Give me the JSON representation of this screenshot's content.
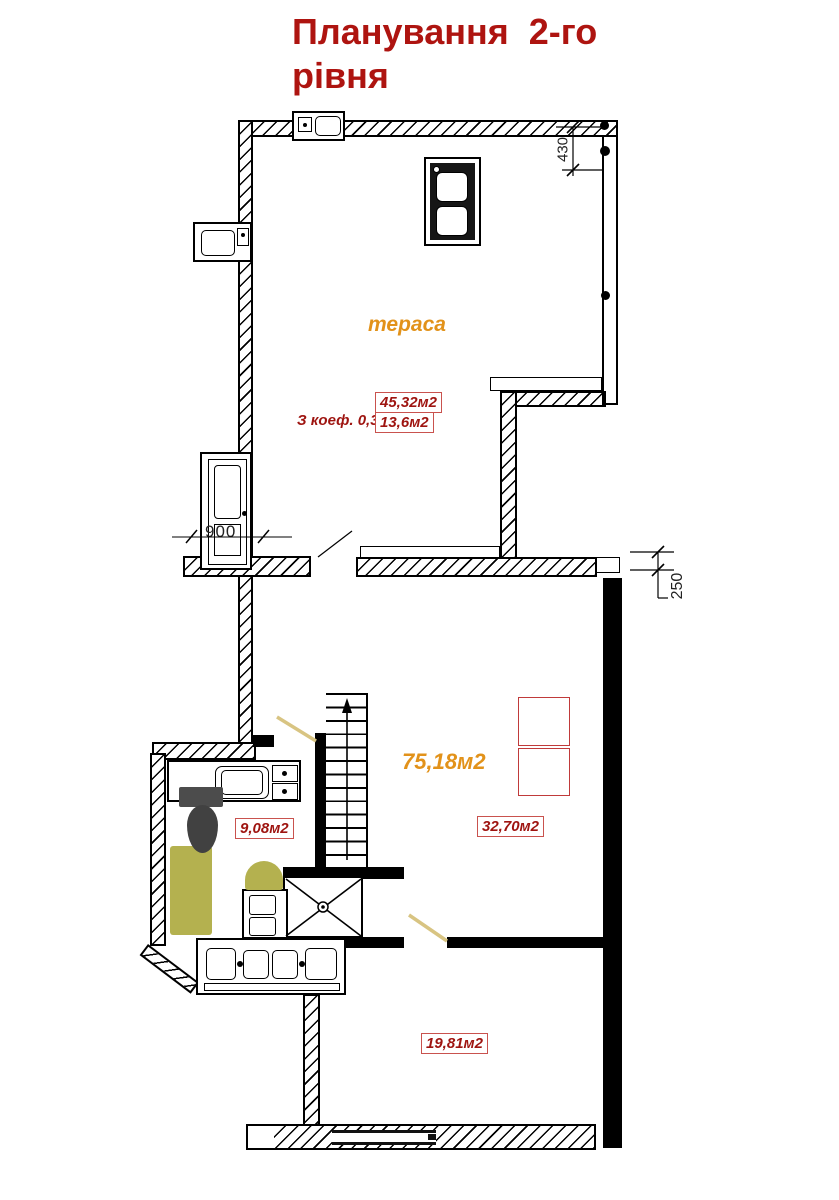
{
  "title": {
    "line1": "Планування  2-го",
    "line2": "рівня"
  },
  "terrace": {
    "label": "тераса",
    "coef_note": "З коеф. 0,3 -",
    "area_total": "45,32м2",
    "area_coef": "13,6м2"
  },
  "areas": {
    "hall": "75,18м2",
    "right_room": "32,70м2",
    "bathroom": "9,08м2",
    "bottom_room": "19,81м2"
  },
  "dims": {
    "d430": "430",
    "d900": "900",
    "d250": "250"
  },
  "colors": {
    "title_red": "#ae1410",
    "label_orange": "#e2921a",
    "area_text_red": "#9e1410",
    "area_box_border": "#c9524e",
    "furniture_red": "#c03a3a",
    "fixture_olive": "#b4b14f",
    "door_leaf_tan": "#d8c482",
    "wall_black": "#000000"
  }
}
